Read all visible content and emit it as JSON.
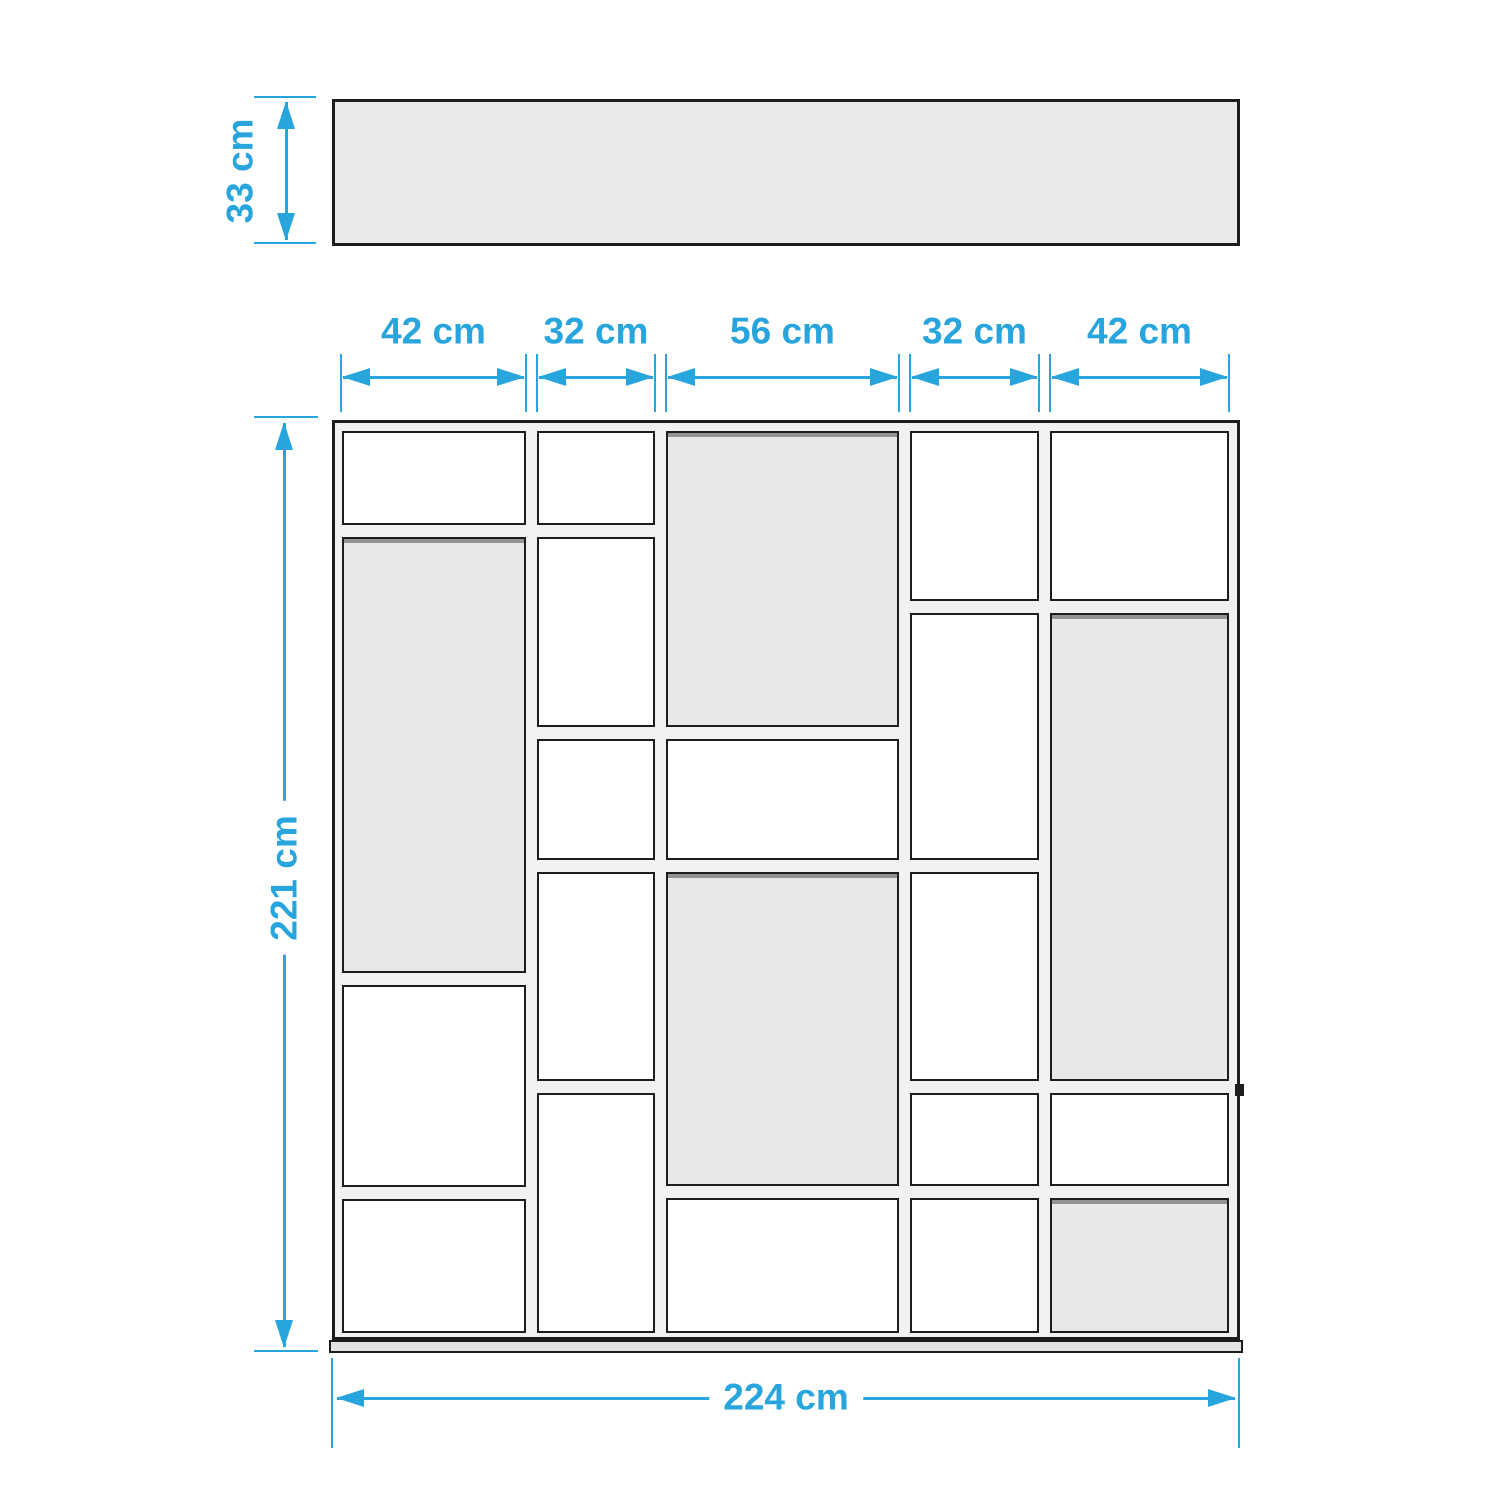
{
  "title": "Shelving unit dimension diagram (top view and front view)",
  "colors": {
    "accent": "#29a5dd",
    "outline": "#1d1d1b",
    "cell_white": "#ffffff",
    "cell_gray": "#e8e8e8",
    "panel": "#f1f1f1",
    "top_view_fill": "#eaeaea",
    "base_fill": "#e3e3e3"
  },
  "dimensions": {
    "depth": {
      "label": "33 cm",
      "value_cm": 33
    },
    "height": {
      "label": "221 cm",
      "value_cm": 221
    },
    "total_width": {
      "label": "224 cm",
      "value_cm": 224
    },
    "column_widths": [
      {
        "label": "42 cm",
        "value_cm": 42
      },
      {
        "label": "32 cm",
        "value_cm": 32
      },
      {
        "label": "56 cm",
        "value_cm": 56
      },
      {
        "label": "32 cm",
        "value_cm": 32
      },
      {
        "label": "42 cm",
        "value_cm": 42
      }
    ]
  },
  "top_view": {
    "x": 332,
    "y": 99,
    "w": 908,
    "h": 147
  },
  "front_view": {
    "x": 332,
    "y": 420,
    "w": 908,
    "h": 920,
    "base": {
      "x": 329,
      "y": 1340,
      "w": 914,
      "h": 13
    },
    "bracket": {
      "x": 1235,
      "y": 1084,
      "w": 9,
      "h": 12
    },
    "columns": [
      {
        "name": "column-1",
        "x": 342,
        "w": 184,
        "cells": [
          {
            "y": 431,
            "h": 94,
            "back": false
          },
          {
            "y": 537,
            "h": 436,
            "back": true
          },
          {
            "y": 985,
            "h": 202,
            "back": false
          },
          {
            "y": 1199,
            "h": 134,
            "back": false
          }
        ]
      },
      {
        "name": "column-2",
        "x": 537,
        "w": 118,
        "cells": [
          {
            "y": 431,
            "h": 94,
            "back": false
          },
          {
            "y": 537,
            "h": 190,
            "back": false
          },
          {
            "y": 739,
            "h": 121,
            "back": false
          },
          {
            "y": 872,
            "h": 209,
            "back": false
          },
          {
            "y": 1093,
            "h": 240,
            "back": false
          }
        ]
      },
      {
        "name": "column-3",
        "x": 666,
        "w": 233,
        "cells": [
          {
            "y": 431,
            "h": 296,
            "back": true
          },
          {
            "y": 739,
            "h": 121,
            "back": false
          },
          {
            "y": 872,
            "h": 314,
            "back": true
          },
          {
            "y": 1198,
            "h": 135,
            "back": false
          }
        ]
      },
      {
        "name": "column-4",
        "x": 910,
        "w": 129,
        "cells": [
          {
            "y": 431,
            "h": 170,
            "back": false
          },
          {
            "y": 613,
            "h": 247,
            "back": false
          },
          {
            "y": 872,
            "h": 209,
            "back": false
          },
          {
            "y": 1093,
            "h": 93,
            "back": false
          },
          {
            "y": 1198,
            "h": 135,
            "back": false
          }
        ]
      },
      {
        "name": "column-5",
        "x": 1050,
        "w": 179,
        "cells": [
          {
            "y": 431,
            "h": 170,
            "back": false
          },
          {
            "y": 613,
            "h": 468,
            "back": true
          },
          {
            "y": 1093,
            "h": 93,
            "back": false
          },
          {
            "y": 1198,
            "h": 135,
            "back": true
          }
        ]
      }
    ]
  },
  "dim_geometry": {
    "depth": {
      "line_x": 286,
      "y1": 102,
      "y2": 240,
      "ext": [
        [
          254,
          97,
          316
        ],
        [
          254,
          243,
          316
        ]
      ],
      "label_cx": 240,
      "label_cy": 171
    },
    "height": {
      "line_x": 284,
      "y1": 423,
      "y2": 1347,
      "ext": [
        [
          254,
          417,
          318
        ],
        [
          254,
          1351,
          318
        ]
      ],
      "label_cx": 284,
      "label_cy": 878
    },
    "total_width": {
      "line_y": 1398,
      "x1": 337,
      "x2": 1235,
      "ext_x": [
        332,
        1239
      ],
      "ext_y1": 1358,
      "ext_y2": 1448,
      "label_cx": 786,
      "label_cy": 1397
    },
    "widths": {
      "line_y": 377,
      "label_cy": 331,
      "ext_y1": 354,
      "ext_y2": 412,
      "spans": [
        [
          341,
          526
        ],
        [
          537,
          655
        ],
        [
          666,
          899
        ],
        [
          910,
          1039
        ],
        [
          1050,
          1229
        ]
      ]
    }
  }
}
